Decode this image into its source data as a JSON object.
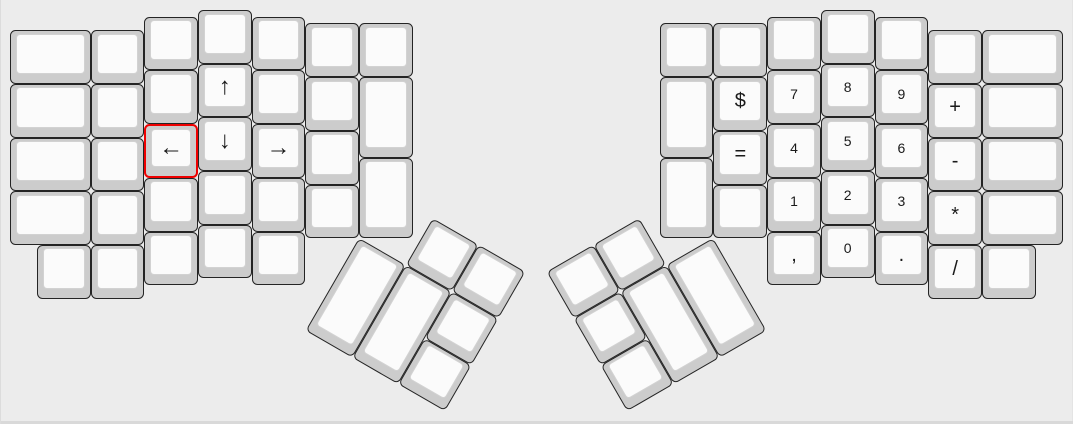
{
  "keyboard": {
    "unit_px": 53.7,
    "origin": {
      "x": 10,
      "y": 10
    },
    "canvas": {
      "width": 1073,
      "height": 424,
      "bg": "#ececec"
    },
    "colors": {
      "cap_side": "#cccccc",
      "cap_top": "#fbfbfb",
      "cap_border": "#242424",
      "selected_border": "#ee0000",
      "label": "#1a1a1a"
    },
    "groups": [
      {
        "name": "left-main",
        "angle": 0
      },
      {
        "name": "left-thumb",
        "angle": 30,
        "cx": 6.5,
        "cy": 4.25
      },
      {
        "name": "right-main",
        "angle": 0
      },
      {
        "name": "right-thumb",
        "angle": -30,
        "cx": 13.1,
        "cy": 4.25
      }
    ],
    "keys": [
      {
        "name": "key-blank",
        "group": "left-main",
        "x": 0,
        "y": 0.375,
        "w": 1.5
      },
      {
        "name": "key-blank",
        "group": "left-main",
        "x": 0,
        "y": 1.375,
        "w": 1.5
      },
      {
        "name": "key-blank",
        "group": "left-main",
        "x": 0,
        "y": 2.375,
        "w": 1.5
      },
      {
        "name": "key-blank",
        "group": "left-main",
        "x": 0,
        "y": 3.375,
        "w": 1.5
      },
      {
        "name": "key-blank",
        "group": "left-main",
        "x": 1.5,
        "y": 0.375
      },
      {
        "name": "key-blank",
        "group": "left-main",
        "x": 1.5,
        "y": 1.375
      },
      {
        "name": "key-blank",
        "group": "left-main",
        "x": 1.5,
        "y": 2.375
      },
      {
        "name": "key-blank",
        "group": "left-main",
        "x": 1.5,
        "y": 3.375
      },
      {
        "name": "key-blank",
        "group": "left-main",
        "x": 2.5,
        "y": 0.125
      },
      {
        "name": "key-blank",
        "group": "left-main",
        "x": 2.5,
        "y": 1.125
      },
      {
        "name": "key-left-arrow",
        "group": "left-main",
        "x": 2.5,
        "y": 2.125,
        "label": "←",
        "size": "lg",
        "selected": true
      },
      {
        "name": "key-blank",
        "group": "left-main",
        "x": 2.5,
        "y": 3.125
      },
      {
        "name": "key-blank",
        "group": "left-main",
        "x": 3.5,
        "y": 0
      },
      {
        "name": "key-up-arrow",
        "group": "left-main",
        "x": 3.5,
        "y": 1,
        "label": "↑",
        "size": "lg"
      },
      {
        "name": "key-down-arrow",
        "group": "left-main",
        "x": 3.5,
        "y": 2,
        "label": "↓",
        "size": "lg"
      },
      {
        "name": "key-blank",
        "group": "left-main",
        "x": 3.5,
        "y": 3
      },
      {
        "name": "key-blank",
        "group": "left-main",
        "x": 4.5,
        "y": 0.125
      },
      {
        "name": "key-blank",
        "group": "left-main",
        "x": 4.5,
        "y": 1.125
      },
      {
        "name": "key-right-arrow",
        "group": "left-main",
        "x": 4.5,
        "y": 2.125,
        "label": "→",
        "size": "lg"
      },
      {
        "name": "key-blank",
        "group": "left-main",
        "x": 4.5,
        "y": 3.125
      },
      {
        "name": "key-blank",
        "group": "left-main",
        "x": 5.5,
        "y": 0.25
      },
      {
        "name": "key-blank",
        "group": "left-main",
        "x": 5.5,
        "y": 1.25
      },
      {
        "name": "key-blank",
        "group": "left-main",
        "x": 5.5,
        "y": 2.25
      },
      {
        "name": "key-blank",
        "group": "left-main",
        "x": 5.5,
        "y": 3.25
      },
      {
        "name": "key-blank",
        "group": "left-main",
        "x": 6.5,
        "y": 0.25
      },
      {
        "name": "key-blank",
        "group": "left-main",
        "x": 6.5,
        "y": 1.25,
        "h": 1.5
      },
      {
        "name": "key-blank",
        "group": "left-main",
        "x": 6.5,
        "y": 2.75,
        "h": 1.5
      },
      {
        "name": "key-blank",
        "group": "left-main",
        "x": 0.5,
        "y": 4.375
      },
      {
        "name": "key-blank",
        "group": "left-main",
        "x": 1.5,
        "y": 4.375
      },
      {
        "name": "key-blank",
        "group": "left-main",
        "x": 2.5,
        "y": 4.125
      },
      {
        "name": "key-blank",
        "group": "left-main",
        "x": 3.5,
        "y": 4
      },
      {
        "name": "key-blank",
        "group": "left-main",
        "x": 4.5,
        "y": 4.125
      },
      {
        "name": "key-blank",
        "group": "left-thumb",
        "x": 1,
        "y": -1
      },
      {
        "name": "key-blank",
        "group": "left-thumb",
        "x": 2,
        "y": -1
      },
      {
        "name": "key-blank",
        "group": "left-thumb",
        "x": 0,
        "y": 0,
        "h": 2
      },
      {
        "name": "key-blank",
        "group": "left-thumb",
        "x": 1,
        "y": 0,
        "h": 2
      },
      {
        "name": "key-blank",
        "group": "left-thumb",
        "x": 2,
        "y": 0
      },
      {
        "name": "key-blank",
        "group": "left-thumb",
        "x": 2,
        "y": 1
      },
      {
        "name": "key-blank",
        "group": "right-main",
        "x": 12.1,
        "y": 0.25
      },
      {
        "name": "key-blank",
        "group": "right-main",
        "x": 12.1,
        "y": 1.25,
        "h": 1.5
      },
      {
        "name": "key-blank",
        "group": "right-main",
        "x": 12.1,
        "y": 2.75,
        "h": 1.5
      },
      {
        "name": "key-blank",
        "group": "right-main",
        "x": 13.1,
        "y": 0.25
      },
      {
        "name": "key-dollar",
        "group": "right-main",
        "x": 13.1,
        "y": 1.25,
        "label": "$",
        "size": "md"
      },
      {
        "name": "key-equals",
        "group": "right-main",
        "x": 13.1,
        "y": 2.25,
        "label": "=",
        "size": "md"
      },
      {
        "name": "key-blank",
        "group": "right-main",
        "x": 13.1,
        "y": 3.25
      },
      {
        "name": "key-blank",
        "group": "right-main",
        "x": 14.1,
        "y": 0.125
      },
      {
        "name": "key-7",
        "group": "right-main",
        "x": 14.1,
        "y": 1.125,
        "label": "7"
      },
      {
        "name": "key-4",
        "group": "right-main",
        "x": 14.1,
        "y": 2.125,
        "label": "4"
      },
      {
        "name": "key-1",
        "group": "right-main",
        "x": 14.1,
        "y": 3.125,
        "label": "1"
      },
      {
        "name": "key-comma",
        "group": "right-main",
        "x": 14.1,
        "y": 4.125,
        "label": ",",
        "size": "md"
      },
      {
        "name": "key-blank",
        "group": "right-main",
        "x": 15.1,
        "y": 0
      },
      {
        "name": "key-8",
        "group": "right-main",
        "x": 15.1,
        "y": 1,
        "label": "8"
      },
      {
        "name": "key-5",
        "group": "right-main",
        "x": 15.1,
        "y": 2,
        "label": "5"
      },
      {
        "name": "key-2",
        "group": "right-main",
        "x": 15.1,
        "y": 3,
        "label": "2"
      },
      {
        "name": "key-0",
        "group": "right-main",
        "x": 15.1,
        "y": 4,
        "label": "0"
      },
      {
        "name": "key-blank",
        "group": "right-main",
        "x": 16.1,
        "y": 0.125
      },
      {
        "name": "key-9",
        "group": "right-main",
        "x": 16.1,
        "y": 1.125,
        "label": "9"
      },
      {
        "name": "key-6",
        "group": "right-main",
        "x": 16.1,
        "y": 2.125,
        "label": "6"
      },
      {
        "name": "key-3",
        "group": "right-main",
        "x": 16.1,
        "y": 3.125,
        "label": "3"
      },
      {
        "name": "key-period",
        "group": "right-main",
        "x": 16.1,
        "y": 4.125,
        "label": ".",
        "size": "md"
      },
      {
        "name": "key-blank",
        "group": "right-main",
        "x": 17.1,
        "y": 0.375
      },
      {
        "name": "key-plus",
        "group": "right-main",
        "x": 17.1,
        "y": 1.375,
        "label": "+",
        "size": "md"
      },
      {
        "name": "key-minus",
        "group": "right-main",
        "x": 17.1,
        "y": 2.375,
        "label": "-",
        "size": "md"
      },
      {
        "name": "key-asterisk",
        "group": "right-main",
        "x": 17.1,
        "y": 3.375,
        "label": "*",
        "size": "md"
      },
      {
        "name": "key-slash",
        "group": "right-main",
        "x": 17.1,
        "y": 4.375,
        "label": "/",
        "size": "md"
      },
      {
        "name": "key-blank",
        "group": "right-main",
        "x": 18.1,
        "y": 0.375,
        "w": 1.5
      },
      {
        "name": "key-blank",
        "group": "right-main",
        "x": 18.1,
        "y": 1.375,
        "w": 1.5
      },
      {
        "name": "key-blank",
        "group": "right-main",
        "x": 18.1,
        "y": 2.375,
        "w": 1.5
      },
      {
        "name": "key-blank",
        "group": "right-main",
        "x": 18.1,
        "y": 3.375,
        "w": 1.5
      },
      {
        "name": "key-blank",
        "group": "right-main",
        "x": 18.1,
        "y": 4.375
      },
      {
        "name": "key-blank",
        "group": "right-thumb",
        "x": -2,
        "y": -1
      },
      {
        "name": "key-blank",
        "group": "right-thumb",
        "x": -3,
        "y": -1
      },
      {
        "name": "key-blank",
        "group": "right-thumb",
        "x": -1,
        "y": 0,
        "h": 2
      },
      {
        "name": "key-blank",
        "group": "right-thumb",
        "x": -2,
        "y": 0,
        "h": 2
      },
      {
        "name": "key-blank",
        "group": "right-thumb",
        "x": -3,
        "y": 0
      },
      {
        "name": "key-blank",
        "group": "right-thumb",
        "x": -3,
        "y": 1
      }
    ]
  }
}
